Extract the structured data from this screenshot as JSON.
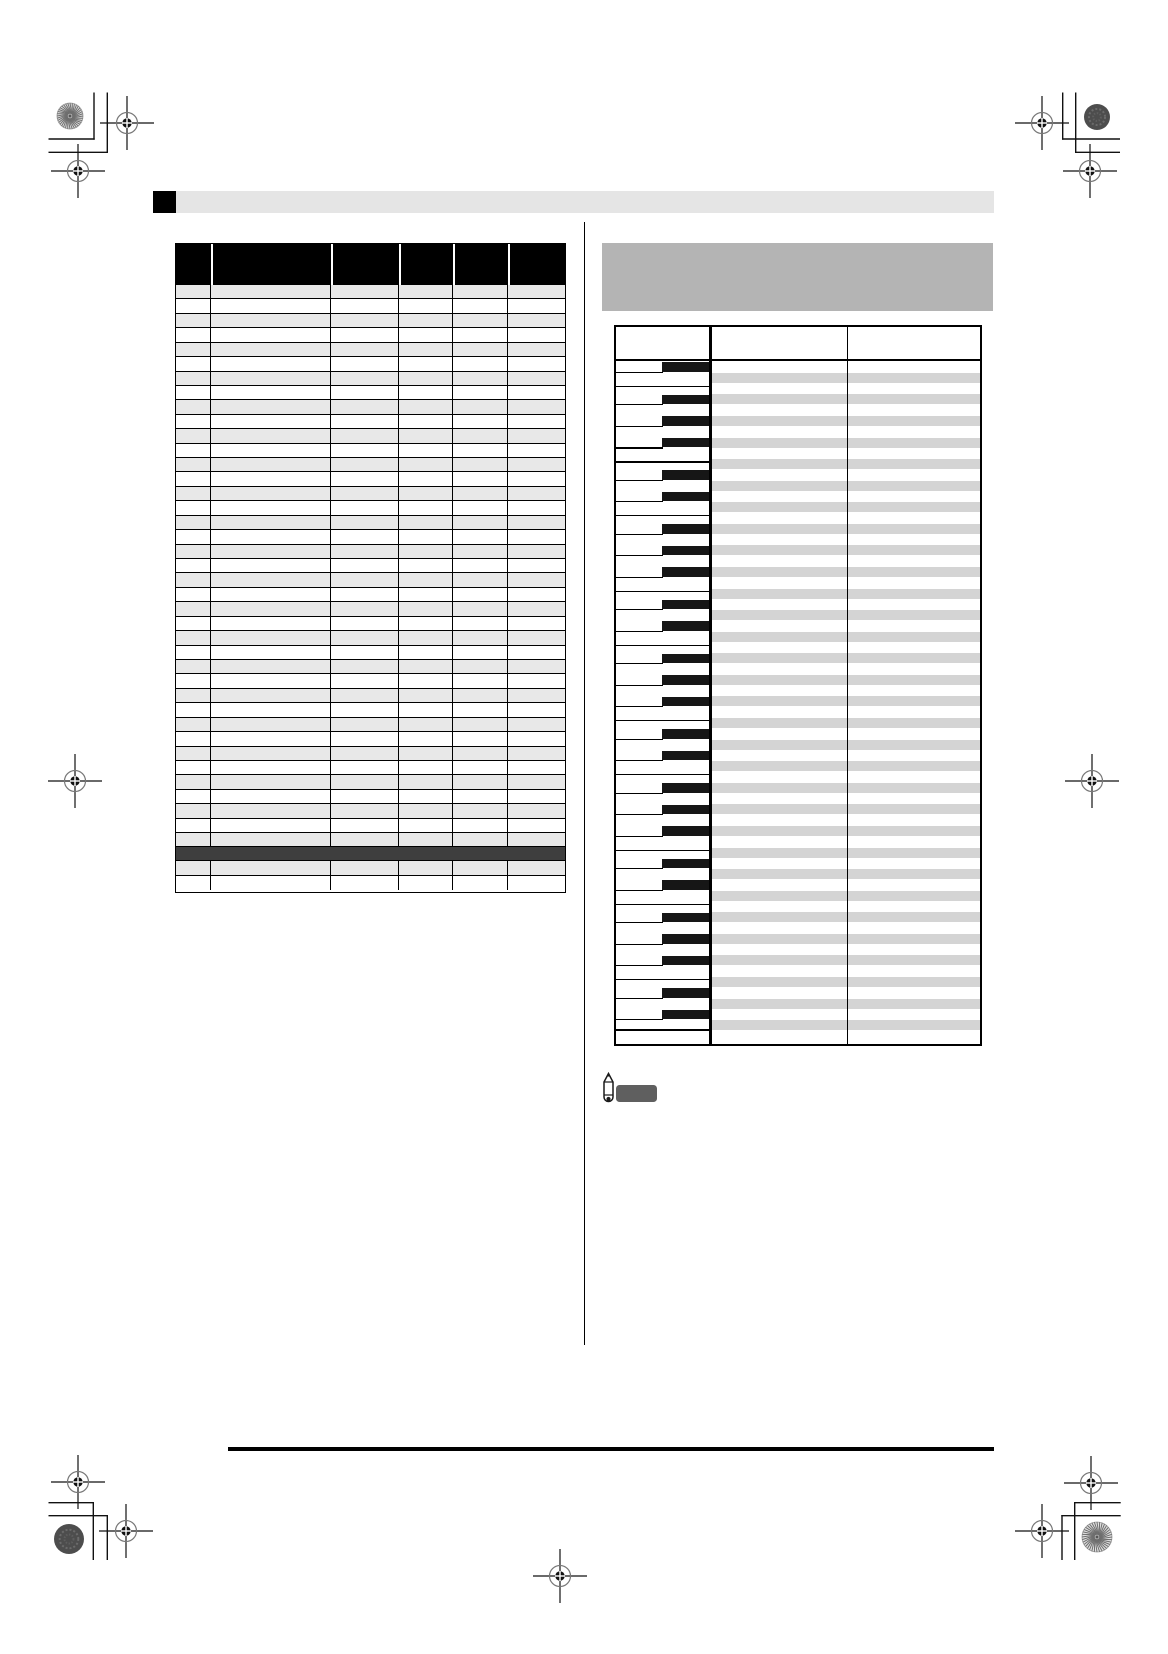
{
  "document": {
    "kind": "printed-manual-appendix-proof-page",
    "visible_text": "",
    "notes": "Page contains no rendered text: blank title bar, blank table cells, keyboard-assignment diagram, printer registration marks."
  },
  "colors": {
    "page_bg": "#ffffff",
    "ink": "#000000",
    "title_bar_fill": "#e5e5e5",
    "title_marker": "#000000",
    "left_table_header_bg": "#000000",
    "left_table_stripe": "#e8e8e8",
    "left_table_highlight_row": "#3e3e3e",
    "section_header_box": "#b4b4b4",
    "right_table_stripe": "#d4d4d4",
    "black_key": "#161616",
    "note_badge": "#5f5f5f"
  },
  "left_table": {
    "columns": 6,
    "col_widths": [
      35,
      120,
      68,
      54,
      55,
      59
    ],
    "header_h": 41,
    "body_rows": 39,
    "row_h": 14.43,
    "highlight_row_h": 13.8,
    "tail_rows": 2
  },
  "right_panel": {
    "table": {
      "rows": 62,
      "row_h": 10.79,
      "keyboard_top": 33.5,
      "keyboard_col_w": 92.5,
      "thick_divider_x": 92.5,
      "thick_divider_w": 3.5,
      "thin_divider_x": 231,
      "black_key_rows_mod12": [
        0,
        3,
        5,
        7,
        10
      ],
      "white_gap_rows_mod12": [
        2,
        9
      ],
      "black_key_w": 47,
      "stripe_x": 96,
      "header_border_y": 31.5,
      "content_w": 364,
      "content_h": 716.5
    }
  },
  "print_marks": {
    "registration_crosses": [
      {
        "x": 127,
        "y": 123
      },
      {
        "x": 78,
        "y": 171
      },
      {
        "x": 1042,
        "y": 123
      },
      {
        "x": 1090,
        "y": 171
      },
      {
        "x": 75,
        "y": 781
      },
      {
        "x": 1092,
        "y": 781
      },
      {
        "x": 78,
        "y": 1482
      },
      {
        "x": 126,
        "y": 1531
      },
      {
        "x": 1091,
        "y": 1483
      },
      {
        "x": 1042,
        "y": 1531
      },
      {
        "x": 560,
        "y": 1576
      }
    ],
    "pattern_circles": [
      {
        "x": 70,
        "y": 116,
        "r": 13,
        "style": "swirl"
      },
      {
        "x": 1097,
        "y": 117,
        "r": 13,
        "style": "noise"
      },
      {
        "x": 69,
        "y": 1539,
        "r": 15,
        "style": "noise"
      },
      {
        "x": 1097,
        "y": 1537,
        "r": 15,
        "style": "swirl"
      }
    ],
    "corner_brackets": [
      [
        94,
        92.5,
        94,
        139.7
      ],
      [
        48.5,
        139,
        94.7,
        139
      ],
      [
        107.3,
        92.5,
        107.3,
        153
      ],
      [
        48.5,
        152.3,
        108,
        152.3
      ],
      [
        1062.7,
        92.5,
        1062.7,
        139.7
      ],
      [
        1062,
        139,
        1120,
        139
      ],
      [
        1075.7,
        92.5,
        1075.7,
        153
      ],
      [
        1075,
        152.3,
        1120,
        152.3
      ],
      [
        93.3,
        1502,
        93.3,
        1560
      ],
      [
        48.5,
        1502.7,
        94,
        1502.7
      ],
      [
        107.3,
        1515,
        107.3,
        1560
      ],
      [
        48.5,
        1515.7,
        108,
        1515.7
      ],
      [
        1074.7,
        1502,
        1074.7,
        1560
      ],
      [
        1074,
        1502.7,
        1120.7,
        1502.7
      ],
      [
        1062,
        1515,
        1062,
        1560
      ],
      [
        1061.3,
        1515.7,
        1120.7,
        1515.7
      ]
    ]
  }
}
